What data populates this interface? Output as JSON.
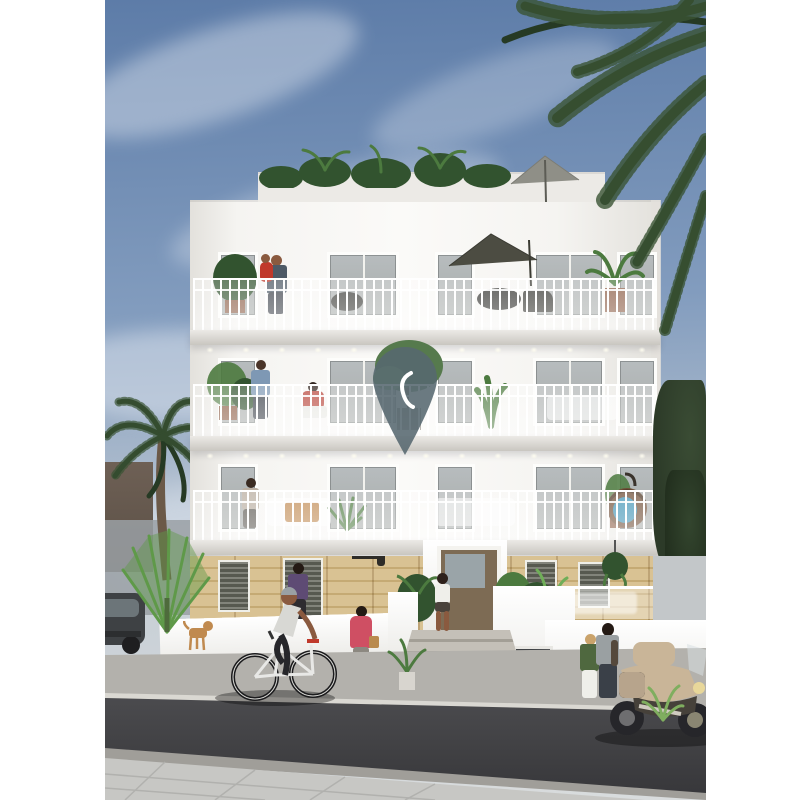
{
  "meta": {
    "width_px": 811,
    "height_px": 800,
    "kind": "architectural exterior rendering, no text visible"
  },
  "scene": {
    "description": "Architectural rendering of a white four-storey Mediterranean apartment building with ornate white balconies, a sandstone ground floor, rooftop terrace with plants and parasols, residents on balconies, a semi-transparent map-pin logo over the centre, palm trees, a cyclist and pedestrians on a sloping street with a parked motorcycle and car",
    "objects": [
      "sky",
      "clouds",
      "palm-fronds-overhang",
      "white-apartment-building",
      "roof-terrace-plants",
      "roof-parasol",
      "balcony-parasol",
      "balcony-railings",
      "balcony-downlights",
      "map-pin-logo",
      "potted-plants",
      "hanging-egg-chair",
      "sandstone-ground-floor",
      "entrance-door",
      "entrance-steps",
      "woman-at-entrance",
      "man-with-child-balcony",
      "man-standing-balcony",
      "woman-sitting-balcony",
      "woman-on-first-floor-balcony",
      "person-in-purple",
      "woman-in-pink-coat",
      "cyclist",
      "dog",
      "parked-car",
      "standing-couple",
      "touring-motorcycle",
      "date-palm-tree",
      "fan-palm",
      "street",
      "sidewalk"
    ]
  },
  "palette": {
    "margin": "#ffffff",
    "sky_top": "#5d7ca8",
    "sky_mid": "#829cbe",
    "sky_horizon": "#c7cfd6",
    "cloud": "#dde4ee",
    "facade": "#f5f4f1",
    "facade_shade": "#e3e1dc",
    "penthouse": "#eceae6",
    "slab": "#eceae6",
    "slab_edge": "#c9c6c0",
    "railing": "#ffffff",
    "glass": "#b7bcbe",
    "window_dark": "#6a6d62",
    "stone_light": "#d9c293",
    "stone_dark": "#c5aa74",
    "stone_joint": "rgba(130,100,50,0.25)",
    "door": "#7d6b54",
    "door_glass": "#9aa4a8",
    "road": "#37373a",
    "road_light": "#4b4b4e",
    "curb": "#a09e99",
    "sidewalk": "#c7c7c4",
    "sidewalk_far": "#b3b1ac",
    "palm_dark": "#263a24",
    "palm_mid": "#3a5434",
    "palm_trunk": "#6b5948",
    "palm_bright": "#5f9a49",
    "tree_dark": "#2c3a28",
    "bg_building": "#6e6055",
    "bg_wall": "#9aa0a4",
    "umbrella_roof": "#8f8f87",
    "umbrella_balcony": "#4c4c42",
    "pin": "rgba(86,104,112,0.88)",
    "pin_mark": "#ffffff",
    "skin": "#8a5a3f",
    "shirt_light": "#d8d8d4",
    "jeans": "#3a4048",
    "red_accent": "#c0392b",
    "purple": "#5e4b74",
    "pink_coat": "#cf4f63",
    "green_jacket": "#4f683f",
    "white_cloth": "#efefea",
    "moto_body": "#c9b598",
    "moto_dark": "#46413a",
    "car_body": "#3e4144",
    "dog": "#c08a4f",
    "egg_chair": "#6f4e36",
    "egg_cushion": "#3f93b5",
    "plant_green": "#4c7a3f",
    "plant_dark": "#32532f",
    "pot": "#8a5a42"
  }
}
